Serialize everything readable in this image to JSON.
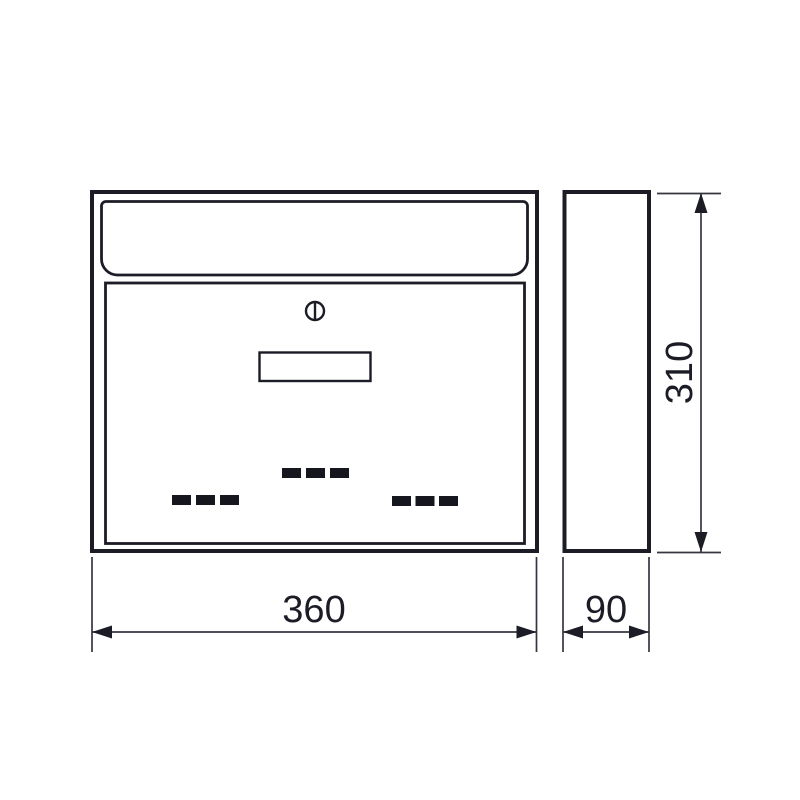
{
  "diagram": {
    "type": "technical-drawing",
    "subject": "wall-mounted mailbox, front and side orthographic views",
    "colors": {
      "line": "#1b1c26",
      "dimension_line": "#35363f",
      "background": "#ffffff"
    },
    "views": {
      "front": {
        "name": "front view"
      },
      "side": {
        "name": "side view"
      }
    },
    "dimensions": {
      "width": {
        "value": "360",
        "orientation": "horizontal",
        "applies_to": "front view width"
      },
      "depth": {
        "value": "90",
        "orientation": "horizontal",
        "applies_to": "side view depth"
      },
      "height": {
        "value": "310",
        "orientation": "vertical",
        "applies_to": "side view height"
      }
    }
  }
}
